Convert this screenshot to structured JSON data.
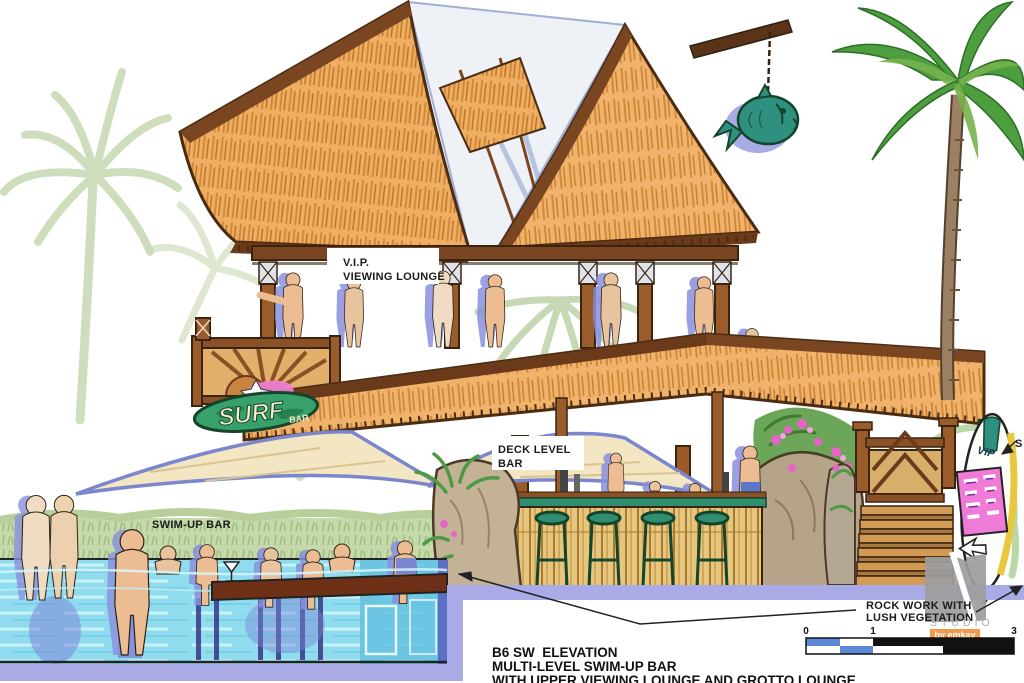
{
  "labels": {
    "vip": {
      "line1": "V.I.P.",
      "line2": "VIEWING LOUNGE"
    },
    "deck": {
      "line1": "DECK LEVEL",
      "line2": "BAR"
    },
    "swim_up": "SWIM-UP BAR",
    "rock": {
      "line1": "ROCK WORK WITH",
      "line2": "LUSH VEGETATION"
    },
    "surfboard_callout": "S"
  },
  "signs": {
    "surf": "SURF",
    "surf_sub": "BAR",
    "vip_board": "VIP"
  },
  "title_block": {
    "line1": "B6 SW  ELEVATION",
    "line2": "MULTI-LEVEL SWIM-UP BAR",
    "line3": "WITH UPPER VIEWING LOUNGE AND GROTTO LOUNGE"
  },
  "scale_bar": {
    "ticks": [
      "0",
      "1",
      "3"
    ]
  },
  "logo": {
    "name": "STUDIO",
    "byline": "by emkay"
  },
  "colors": {
    "thatch": "#efae62",
    "wood": "#8b5126",
    "pool_aqua": "#8fdcee",
    "periwinkle_band": "#a9aae6",
    "teal": "#2f9080",
    "bougainvillea_pink": "#e763c8",
    "scale_blue": "#5c88d8",
    "logo_orange": "#f09a4d"
  }
}
